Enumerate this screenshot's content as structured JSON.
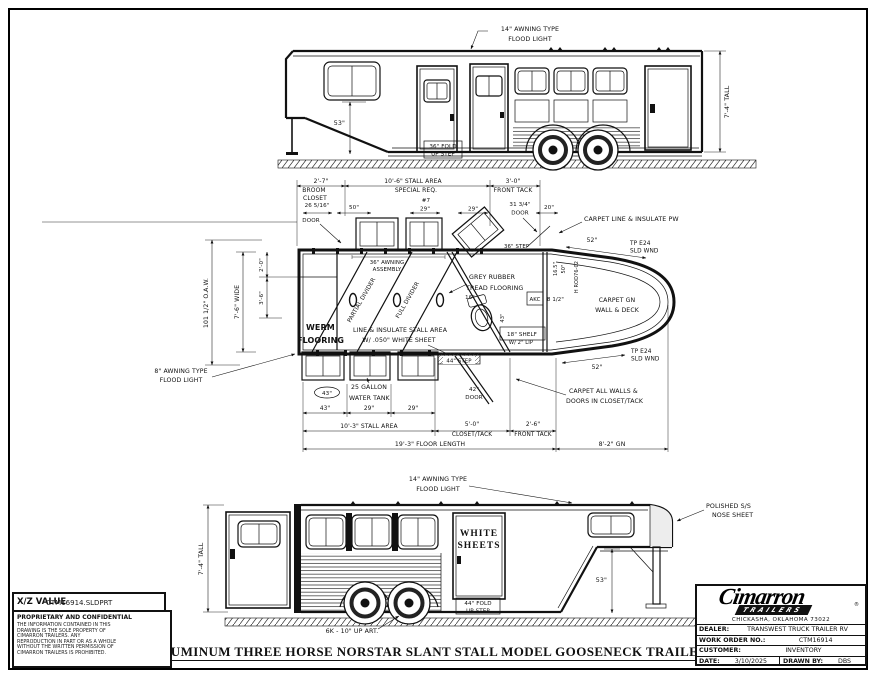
{
  "frame": {
    "title": "ALUMINUM THREE HORSE NORSTAR SLANT STALL MODEL GOOSENECK TRAILER"
  },
  "top_view": {
    "flood_light_1": "14\" AWNING TYPE",
    "flood_light_2": "FLOOD LIGHT",
    "gn_height_dim": "53\"",
    "step_1": "36\" FOLD",
    "step_2": "UP STEP",
    "height_dim": "7'-4\" TALL"
  },
  "plan_view": {
    "broom_dim": "2'-7\"",
    "broom_1": "BROOM",
    "broom_2": "CLOSET",
    "stall_area_top": "10'-6\" STALL AREA",
    "special_req": "SPECIAL REQ.",
    "front_tack_dim_top": "3'-0\"",
    "front_tack_top": "FRONT TACK",
    "door_26_dim": "26 5/16\"",
    "door_26_label": "DOOR",
    "dim_50": "50\"",
    "tag_7": "#7",
    "dim_29_a": "29\"",
    "dim_29_b": "29\"",
    "door_31_dim": "31 3/4\"",
    "door_31_label": "DOOR",
    "dim_20": "20\"",
    "carpet_pw": "CARPET LINE & INSULATE PW",
    "dim_52_top": "52\"",
    "sld_wnd_top_1": "TP E24",
    "sld_wnd_top_2": "SLD WND",
    "awning_1": "36\" AWNING",
    "awning_2": "ASSEMBLY",
    "partial_divider": "PARTIAL DIVIDER",
    "full_divider": "FULL DIVIDER",
    "grey_rubber_1": "GREY RUBBER",
    "grey_rubber_2": "TREAD FLOORING",
    "dim_16": "16\"",
    "step_36": "36\" STEP",
    "werm_1": "WERM",
    "werm_2": "FLOORING",
    "insulate_1": "LINE & INSULATE STALL AREA",
    "insulate_2": "W/ .050\" WHITE SHEET",
    "tank_1": "25 GALLON",
    "tank_2": "WATER TANK",
    "window_tag_43": "43\"",
    "flood_8_1": "8\" AWNING TYPE",
    "flood_8_2": "FLOOD LIGHT",
    "oaw_dim": "101 1/2\" O.A.W.",
    "wide_dim": "7'-6\" WIDE",
    "dim_2_0": "2'-0\"",
    "dim_3_6": "3'-6\"",
    "akc": "AKC",
    "dim_8_5": "8 1/2\"",
    "dim_43_v": "43\"",
    "shelf_1": "18\" SHELF",
    "shelf_2": "W/ 2\" LIP",
    "step_44": "44\" STEP",
    "door_42_dim": "42\"",
    "door_42_label": "DOOR",
    "carpet_gn_1": "CARPET GN",
    "carpet_gn_2": "WALL & DECK",
    "dim_52_bot": "52\"",
    "sld_wnd_bot_1": "TP E24",
    "sld_wnd_bot_2": "SLD WND",
    "carpet_all_1": "CARPET ALL WALLS &",
    "carpet_all_2": "DOORS IN CLOSET/TACK",
    "dim_43_b": "43\"",
    "dim_29_c": "29\"",
    "dim_29_d": "29\"",
    "stall_area_bot": "10'-3\" STALL AREA",
    "closet_tack_dim": "5'-0\"",
    "closet_tack": "CLOSET/TACK",
    "front_tack_dim_bot": "2'-6\"",
    "front_tack_bot": "FRONT TACK",
    "floor_length": "19'-3\" FLOOR LENGTH",
    "gn_length": "8'-2\" GN",
    "gn_tag_1": "16.5\"",
    "gn_tag_2": "50\"",
    "gn_part": "H ROD76-02"
  },
  "bottom_view": {
    "flood_light_1": "14\" AWNING TYPE",
    "flood_light_2": "FLOOD LIGHT",
    "height_dim": "7'-4\" TALL",
    "white_1": "WHITE",
    "white_2": "SHEETS",
    "step_1": "44\" FOLD",
    "step_2": "UP STEP",
    "axle_label": "6K - 10\" UP ART.",
    "nose_1": "POLISHED S/S",
    "nose_2": "NOSE SHEET",
    "gn_height_dim": "53\""
  },
  "footer": {
    "file_label": "X/Z VALUE",
    "file_name": "CTM16914.SLDPRT",
    "proprietary_title": "PROPRIETARY AND CONFIDENTIAL",
    "proprietary_body": "THE INFORMATION CONTAINED IN THIS DRAWING IS THE SOLE PROPERTY OF CIMARRON TRAILERS. ANY REPRODUCTION IN PART OR AS A WHOLE WITHOUT THE WRITTEN PERMISSION OF CIMARRON TRAILERS IS PROHIBITED."
  },
  "title_block": {
    "brand": "Cimarron",
    "brand_sub": "TRAILERS",
    "address": "CHICKASHA, OKLAHOMA 73022",
    "dealer_label": "DEALER:",
    "dealer": "TRANSWEST TRUCK TRAILER RV",
    "work_order_label": "WORK ORDER NO.:",
    "work_order": "CTM16914",
    "customer_label": "CUSTOMER:",
    "customer": "INVENTORY",
    "date_label": "DATE:",
    "date": "3/10/2025",
    "drawn_by_label": "DRAWN BY:",
    "drawn_by": "DBS"
  }
}
